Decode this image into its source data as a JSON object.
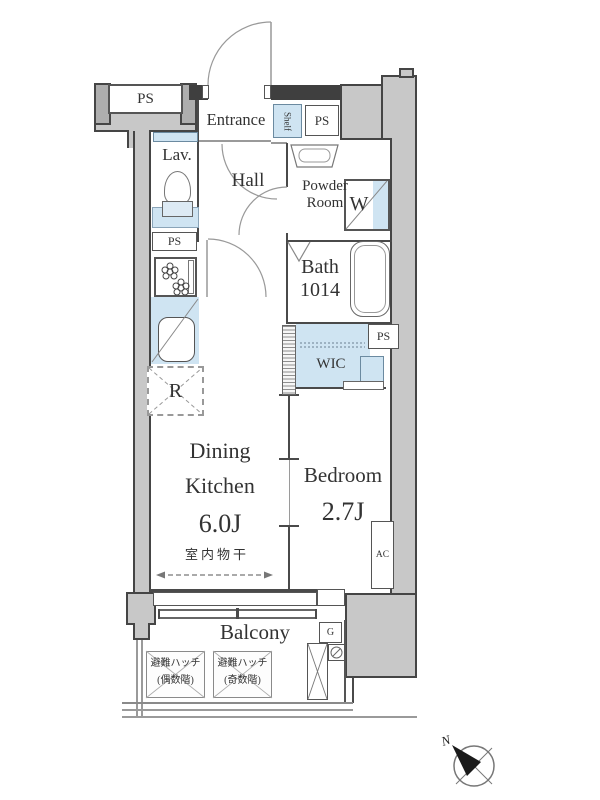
{
  "labels": {
    "ps_top_left": "PS",
    "entrance": "Entrance",
    "shelf": "Shelf",
    "ps_entrance": "PS",
    "lavatory": "Lav.",
    "hall": "Hall",
    "powder_room_1": "Powder",
    "powder_room_2": "Room",
    "washer": "W",
    "ps_lavatory": "PS",
    "bath_1": "Bath",
    "bath_2": "1014",
    "ps_bath": "PS",
    "wic": "WIC",
    "refrigerator": "R",
    "dining_1": "Dining",
    "dining_2": "Kitchen",
    "dining_size": "6.0J",
    "bedroom": "Bedroom",
    "bedroom_size": "2.7J",
    "indoor_drying": "室内物干",
    "ac": "AC",
    "balcony": "Balcony",
    "hatch_title": "避難ハッチ",
    "hatch_even": "(偶数階)",
    "hatch_odd": "(奇数階)",
    "gas": "G",
    "north": "N"
  },
  "colors": {
    "common_area_gray": "#c8c8c8",
    "wall_dark": "#3f3f3f",
    "water_blue": "#cfe4f2",
    "line_gray": "#8a8a8a",
    "text": "#333333"
  }
}
